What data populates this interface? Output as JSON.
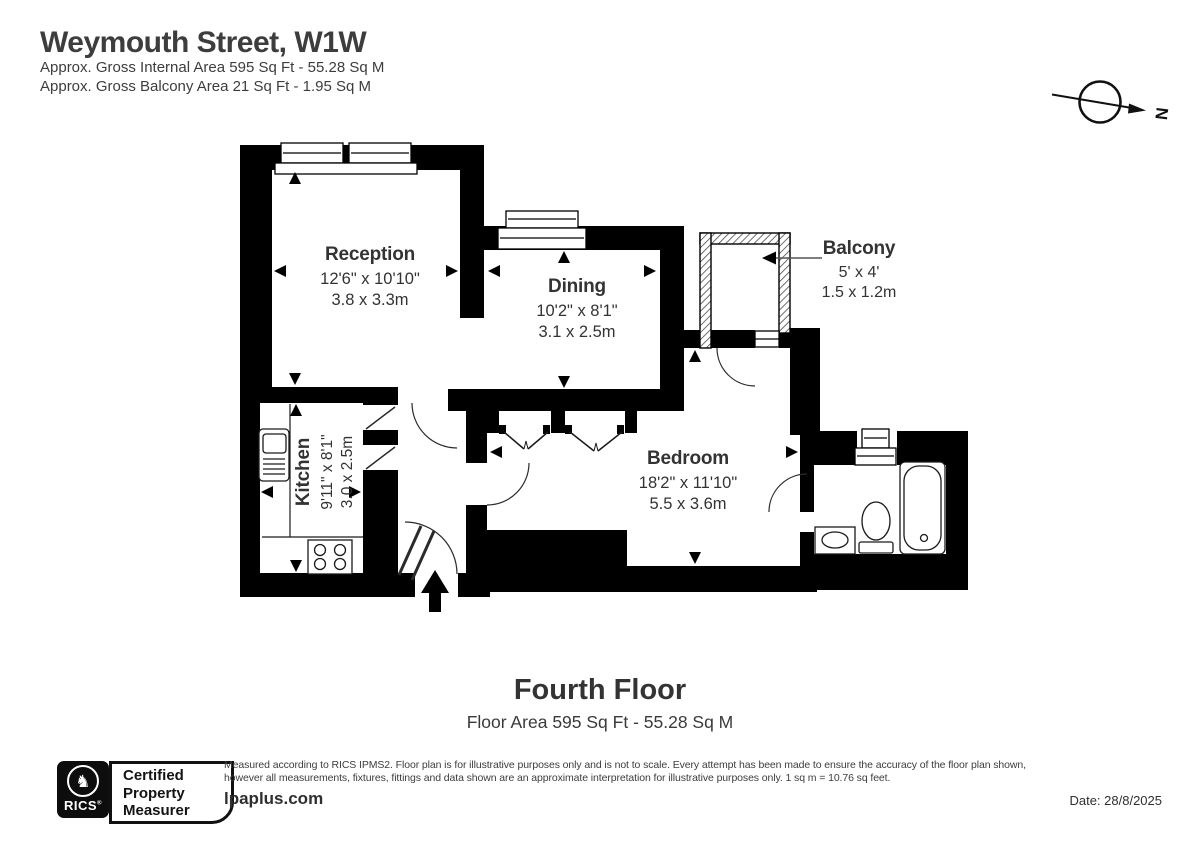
{
  "header": {
    "title": "Weymouth Street, W1W",
    "subtitle1": "Approx. Gross Internal Area 595 Sq Ft - 55.28 Sq M",
    "subtitle2": "Approx. Gross Balcony Area 21 Sq Ft - 1.95 Sq M"
  },
  "compass": {
    "north": "N"
  },
  "rooms": {
    "reception": {
      "name": "Reception",
      "imperial": "12'6\" x 10'10\"",
      "metric": "3.8 x 3.3m"
    },
    "dining": {
      "name": "Dining",
      "imperial": "10'2\" x 8'1\"",
      "metric": "3.1 x 2.5m"
    },
    "balcony": {
      "name": "Balcony",
      "imperial": "5' x 4'",
      "metric": "1.5 x 1.2m"
    },
    "kitchen": {
      "name": "Kitchen",
      "imperial": "9'11\" x 8'1\"",
      "metric": "3.0 x 2.5m"
    },
    "bedroom": {
      "name": "Bedroom",
      "imperial": "18'2\" x 11'10\"",
      "metric": "5.5 x 3.6m"
    }
  },
  "floor": {
    "title": "Fourth Floor",
    "area": "Floor Area 595 Sq Ft - 55.28 Sq M"
  },
  "footer": {
    "rics_label": "RICS",
    "rics_reg": "®",
    "badge_lines": [
      "Certified",
      "Property",
      "Measurer"
    ],
    "disclaimer_line1": "Measured according to RICS IPMS2. Floor plan is for illustrative purposes only and is not to scale. Every attempt has been made to ensure the accuracy of the floor plan shown,",
    "disclaimer_line2": "however all measurements, fixtures, fittings and data shown are an approximate interpretation for illustrative purposes only. 1 sq m = 10.76 sq feet.",
    "website": "lpaplus.com",
    "date": "Date: 28/8/2025"
  },
  "colors": {
    "wall": "#000000",
    "text": "#3a3a3a"
  }
}
